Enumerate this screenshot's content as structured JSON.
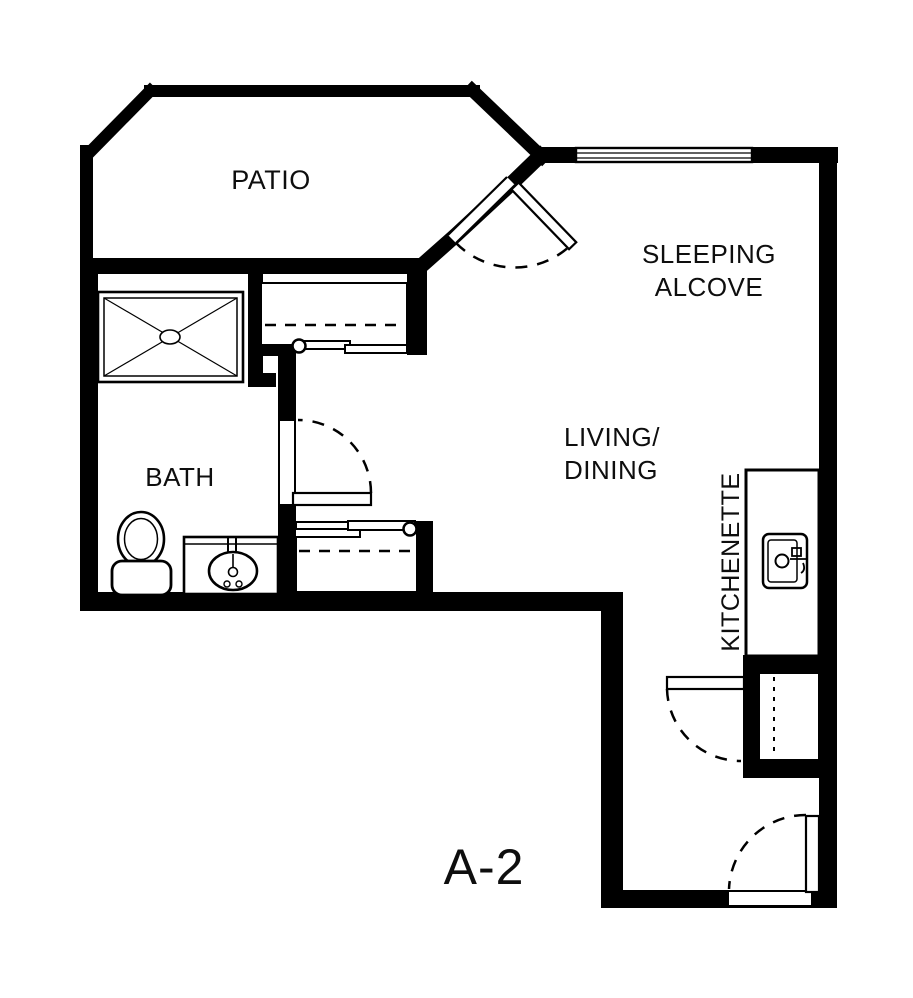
{
  "floor_plan": {
    "unit_label": "A-2",
    "colors": {
      "wall": "#000000",
      "floor": "#ffffff",
      "label": "#0e0e0e"
    },
    "labels": {
      "patio": "PATIO",
      "sleeping_alcove_line1": "SLEEPING",
      "sleeping_alcove_line2": "ALCOVE",
      "living_dining_line1": "LIVING/",
      "living_dining_line2": "DINING",
      "bath": "BATH",
      "kitchenette": "KITCHENETTE"
    },
    "fixtures": [
      "shower",
      "toilet",
      "vanity-sink",
      "kitchenette-sink",
      "upper-closet",
      "lower-closet",
      "utility-closet"
    ],
    "doors": [
      "patio-door",
      "bath-door",
      "storage-closet-door",
      "entry-door"
    ],
    "windows": [
      "sleeping-alcove-window"
    ]
  }
}
